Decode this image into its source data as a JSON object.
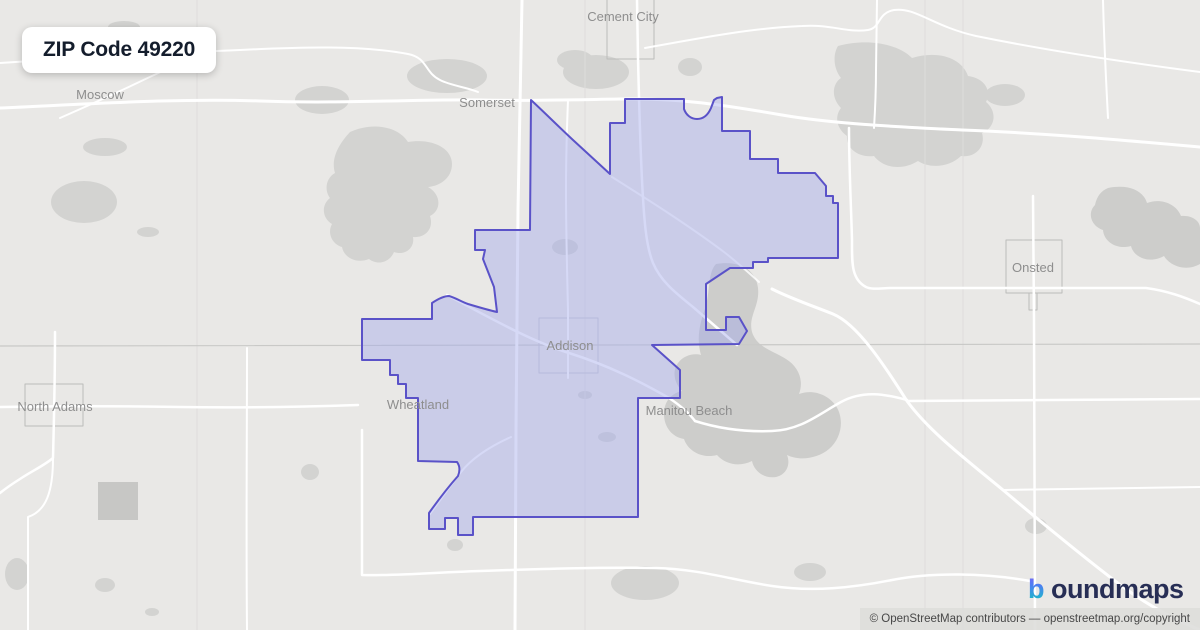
{
  "badge": {
    "title": "ZIP Code 49220"
  },
  "logo": {
    "icon_char": "b",
    "text": "oundmaps",
    "text_color": "#272e55",
    "gradient": [
      "#8b5cf6",
      "#4f7df3",
      "#1cb8c9"
    ]
  },
  "attribution": {
    "text": "© OpenStreetMap contributors — openstreetmap.org/copyright"
  },
  "map": {
    "bg": "#e9e8e6",
    "colors": {
      "patch": "#d3d3d1",
      "patch_dark": "#c7c7c5",
      "water": "#cdcdcb",
      "road": "#ffffff",
      "grid": "#dedddc",
      "county_line": "#c9c9c7",
      "village_square": "#bcbcba",
      "boundary_stroke": "#5a52c8",
      "boundary_fill": "rgba(164,170,234,0.45)"
    },
    "shapes": [
      {
        "name": "map-background",
        "type": "rect",
        "x": 0,
        "y": 0,
        "w": 1200,
        "h": 630,
        "fill": "#e9e8e6"
      },
      {
        "name": "woods-patch",
        "type": "ellipse",
        "cx": 124,
        "cy": 27,
        "rx": 16,
        "ry": 6,
        "fill": "#d3d3d1"
      },
      {
        "name": "woods-patch",
        "type": "ellipse",
        "cx": 322,
        "cy": 100,
        "rx": 27,
        "ry": 14,
        "fill": "#d3d3d1"
      },
      {
        "name": "woods-patch",
        "type": "ellipse",
        "cx": 105,
        "cy": 147,
        "rx": 22,
        "ry": 9,
        "fill": "#d3d3d1"
      },
      {
        "name": "woods-patch",
        "type": "ellipse",
        "cx": 84,
        "cy": 202,
        "rx": 33,
        "ry": 21,
        "fill": "#d3d3d1"
      },
      {
        "name": "woods-patch",
        "type": "ellipse",
        "cx": 148,
        "cy": 232,
        "rx": 11,
        "ry": 5,
        "fill": "#d3d3d1"
      },
      {
        "name": "woods-patch",
        "type": "ellipse",
        "cx": 447,
        "cy": 76,
        "rx": 40,
        "ry": 17,
        "fill": "#d3d3d1"
      },
      {
        "name": "woods-patch",
        "type": "ellipse",
        "cx": 596,
        "cy": 72,
        "rx": 33,
        "ry": 17,
        "fill": "#d3d3d1"
      },
      {
        "name": "woods-patch",
        "type": "ellipse",
        "cx": 575,
        "cy": 60,
        "rx": 18,
        "ry": 10,
        "fill": "#d3d3d1"
      },
      {
        "name": "woods-patch",
        "type": "ellipse",
        "cx": 690,
        "cy": 67,
        "rx": 12,
        "ry": 9,
        "fill": "#d3d3d1"
      },
      {
        "name": "forest-northwest",
        "type": "path",
        "fill": "#d3d3d1",
        "d": "M350,132 C372,122 398,126 408,142 C432,138 452,148 452,164 C452,178 440,186 428,187 C441,194 442,210 430,216 C434,228 426,238 413,237 C415,248 405,256 394,252 C390,262 378,266 369,259 C357,264 344,258 342,247 C332,244 327,233 332,224 C322,218 321,205 330,198 C324,190 326,178 335,173 C331,160 337,146 350,132 Z"
      },
      {
        "name": "forest-northeast",
        "type": "path",
        "fill": "#d3d3d1",
        "d": "M838,46 C868,38 898,44 912,58 C938,50 962,58 968,76 C984,78 992,90 986,102 C998,112 995,128 982,133 C986,147 975,158 961,156 C950,167 930,169 918,161 C902,171 883,168 874,156 C858,158 846,148 847,136 C837,129 834,117 841,108 C831,98 832,84 841,78 C833,68 833,54 838,46 Z"
      },
      {
        "name": "woods-patch",
        "type": "ellipse",
        "cx": 1005,
        "cy": 95,
        "rx": 20,
        "ry": 11,
        "fill": "#d3d3d1"
      },
      {
        "name": "lake-east",
        "type": "path",
        "fill": "#cdcdcb",
        "d": "M1108,188 C1128,184 1143,190 1147,203 C1160,198 1176,203 1181,216 C1192,215 1200,221 1200,228 L1200,264 C1186,272 1170,266 1164,256 C1150,264 1134,258 1131,246 C1117,250 1104,242 1103,230 C1091,226 1087,213 1095,205 C1097,196 1101,191 1108,188 Z"
      },
      {
        "name": "devils-lake",
        "type": "path",
        "fill": "#cdcdcb",
        "d": "M716,264 C740,260 756,270 758,288 C760,306 748,316 752,332 C757,348 774,351 786,359 C799,367 804,381 799,394 C812,389 828,394 836,406 C845,420 841,439 829,449 C817,459 799,461 787,455 C791,465 786,475 776,477 C764,479 754,471 752,461 C740,467 726,465 717,455 C702,459 688,451 684,439 C672,437 664,427 664,414 C664,401 672,393 682,391 C674,383 672,371 678,363 C684,355 694,353 701,355 C696,338 700,322 706,306 C710,290 708,272 716,264 Z"
      },
      {
        "name": "woods-patch",
        "type": "ellipse",
        "cx": 565,
        "cy": 247,
        "rx": 13,
        "ry": 8,
        "fill": "#d3d3d1"
      },
      {
        "name": "woods-patch",
        "type": "ellipse",
        "cx": 585,
        "cy": 395,
        "rx": 7,
        "ry": 4,
        "fill": "#d3d3d1"
      },
      {
        "name": "woods-patch",
        "type": "ellipse",
        "cx": 607,
        "cy": 437,
        "rx": 9,
        "ry": 5,
        "fill": "#d3d3d1"
      },
      {
        "name": "woods-patch",
        "type": "ellipse",
        "cx": 645,
        "cy": 583,
        "rx": 34,
        "ry": 17,
        "fill": "#d3d3d1"
      },
      {
        "name": "woods-patch",
        "type": "ellipse",
        "cx": 810,
        "cy": 572,
        "rx": 16,
        "ry": 9,
        "fill": "#d3d3d1"
      },
      {
        "name": "woods-patch",
        "type": "ellipse",
        "cx": 1036,
        "cy": 526,
        "rx": 11,
        "ry": 8,
        "fill": "#d3d3d1"
      },
      {
        "name": "woods-patch-dark",
        "type": "rect",
        "x": 98,
        "y": 482,
        "w": 40,
        "h": 38,
        "fill": "#c7c7c5"
      },
      {
        "name": "woods-patch",
        "type": "ellipse",
        "cx": 17,
        "cy": 574,
        "rx": 12,
        "ry": 16,
        "fill": "#d3d3d1"
      },
      {
        "name": "woods-patch",
        "type": "ellipse",
        "cx": 105,
        "cy": 585,
        "rx": 10,
        "ry": 7,
        "fill": "#d3d3d1"
      },
      {
        "name": "woods-patch",
        "type": "ellipse",
        "cx": 152,
        "cy": 612,
        "rx": 7,
        "ry": 4,
        "fill": "#d3d3d1"
      },
      {
        "name": "woods-patch",
        "type": "ellipse",
        "cx": 310,
        "cy": 472,
        "rx": 9,
        "ry": 8,
        "fill": "#d3d3d1"
      },
      {
        "name": "woods-patch",
        "type": "ellipse",
        "cx": 455,
        "cy": 545,
        "rx": 8,
        "ry": 6,
        "fill": "#d3d3d1"
      },
      {
        "name": "section-line",
        "type": "line",
        "x1": 197,
        "y1": 0,
        "x2": 197,
        "y2": 630,
        "stroke": "#dedddc",
        "width": 1
      },
      {
        "name": "section-line",
        "type": "line",
        "x1": 585,
        "y1": 0,
        "x2": 585,
        "y2": 630,
        "stroke": "#dedddc",
        "width": 1
      },
      {
        "name": "section-line",
        "type": "line",
        "x1": 925,
        "y1": 0,
        "x2": 925,
        "y2": 630,
        "stroke": "#dedddc",
        "width": 1
      },
      {
        "name": "section-line",
        "type": "line",
        "x1": 963,
        "y1": 0,
        "x2": 963,
        "y2": 630,
        "stroke": "#dedddc",
        "width": 1
      },
      {
        "name": "county-line",
        "type": "line",
        "x1": 0,
        "y1": 346,
        "x2": 1200,
        "y2": 344,
        "stroke": "#c9c9c7",
        "width": 1.2
      },
      {
        "name": "village-square-cement-city",
        "type": "rect",
        "x": 607,
        "y": -8,
        "w": 47,
        "h": 67,
        "fill": "none",
        "stroke": "#bcbcba",
        "width": 1
      },
      {
        "name": "village-square-addison",
        "type": "rect",
        "x": 539,
        "y": 318,
        "w": 59,
        "h": 55,
        "fill": "none",
        "stroke": "#c6c6ce",
        "width": 1
      },
      {
        "name": "village-square-onsted",
        "type": "rect",
        "x": 1006,
        "y": 240,
        "w": 56,
        "h": 53,
        "fill": "none",
        "stroke": "#bcbcba",
        "width": 1
      },
      {
        "name": "village-square-onsted-tab",
        "type": "path",
        "fill": "none",
        "stroke": "#bcbcba",
        "width": 1,
        "d": "M1029,293 L1029,310 L1037,310 L1037,293"
      },
      {
        "name": "village-square-north-adams",
        "type": "rect",
        "x": 25,
        "y": 384,
        "w": 58,
        "h": 42,
        "fill": "none",
        "stroke": "#bcbcba",
        "width": 1
      },
      {
        "name": "road-somerset-highway",
        "type": "path",
        "fill": "none",
        "stroke": "#ffffff",
        "width": 3,
        "d": "M0,108 C90,104 180,98 260,101 C340,104 420,99 480,100 C520,101 560,100 620,99 C680,98 724,105 782,115 C834,124 902,127 962,130 C1042,133 1122,140 1200,147"
      },
      {
        "name": "road-top-left",
        "type": "path",
        "fill": "none",
        "stroke": "#ffffff",
        "width": 2,
        "d": "M0,63 C80,58 160,53 240,50 C300,47 362,45 408,54 C428,58 424,72 440,80 C452,86 466,87 478,92"
      },
      {
        "name": "road-north-loop",
        "type": "path",
        "fill": "none",
        "stroke": "#ffffff",
        "width": 2,
        "d": "M645,48 C700,38 752,28 802,26 C832,24 846,33 868,30 C881,28 877,13 894,10 C916,7 932,26 976,36 C1030,47 1100,59 1200,72"
      },
      {
        "name": "road-moscow-diagonal",
        "type": "path",
        "fill": "none",
        "stroke": "#ffffff",
        "width": 2,
        "d": "M60,118 C85,107 110,96 135,84 C160,72 186,60 212,50"
      },
      {
        "name": "road-west-vertical",
        "type": "path",
        "fill": "none",
        "stroke": "#ffffff",
        "width": 3,
        "d": "M522,0 C521,70 519,140 518,210 C517,290 516,360 516,430 C516,500 515,565 515,630"
      },
      {
        "name": "road-cement-city",
        "type": "path",
        "fill": "none",
        "stroke": "#ffffff",
        "width": 2.5,
        "d": "M637,0 L638,58 C639,100 640,140 642,180 C644,220 646,246 653,263 C661,282 677,294 693,307 C707,319 723,333 737,345"
      },
      {
        "name": "road-top-vertical",
        "type": "path",
        "fill": "none",
        "stroke": "#ffffff",
        "width": 2,
        "d": "M877,0 L876,70 C876,95 875,112 874,128"
      },
      {
        "name": "road-top-right-vertical",
        "type": "path",
        "fill": "none",
        "stroke": "#ffffff",
        "width": 2,
        "d": "M1103,0 C1104,40 1106,80 1108,118"
      },
      {
        "name": "road-addison-north",
        "type": "path",
        "fill": "none",
        "stroke": "#ffffff",
        "width": 2,
        "d": "M568,378 L568,310 C567,270 566,230 566,190 C566,150 567,125 568,100"
      },
      {
        "name": "road-inner-diagonal",
        "type": "path",
        "fill": "none",
        "stroke": "#ffffff",
        "width": 2,
        "opacity": 0.8,
        "d": "M612,177 C650,201 688,225 724,252 C737,262 748,272 759,282"
      },
      {
        "name": "road-addison-northwest",
        "type": "path",
        "fill": "none",
        "stroke": "#ffffff",
        "width": 2.5,
        "d": "M447,295 C490,318 531,341 569,353 C610,366 641,382 669,398 C681,406 689,413 695,421"
      },
      {
        "name": "road-notch",
        "type": "path",
        "fill": "none",
        "stroke": "#ffffff",
        "width": 2,
        "d": "M430,514 C441,499 451,485 461,472 C473,457 491,446 511,437"
      },
      {
        "name": "road-manitou",
        "type": "path",
        "fill": "none",
        "stroke": "#ffffff",
        "width": 2.5,
        "d": "M695,421 C720,429 746,432 772,431 C801,430 819,414 841,402 C863,390 885,394 907,400"
      },
      {
        "name": "road-se-diagonal",
        "type": "path",
        "fill": "none",
        "stroke": "#ffffff",
        "width": 3,
        "d": "M772,289 C792,299 813,306 833,314 C857,324 883,363 907,401 C929,431 963,457 1003,490 C1041,522 1081,555 1119,584 C1147,605 1173,619 1200,630"
      },
      {
        "name": "road-east-corner",
        "type": "path",
        "fill": "none",
        "stroke": "#ffffff",
        "width": 2.5,
        "d": "M849,128 C849,166 851,204 852,240 C852,262 851,279 866,287 C872,290 882,288 892,288 L1146,288 C1168,291 1184,297 1200,304"
      },
      {
        "name": "road-onsted-vertical",
        "type": "path",
        "fill": "none",
        "stroke": "#ffffff",
        "width": 2.5,
        "d": "M1033,196 L1034,320 C1034,420 1035,520 1035,630"
      },
      {
        "name": "road-east-h400",
        "type": "path",
        "fill": "none",
        "stroke": "#ffffff",
        "width": 2.5,
        "d": "M907,401 C1004,401 1102,399 1200,399"
      },
      {
        "name": "road-east-h488",
        "type": "path",
        "fill": "none",
        "stroke": "#ffffff",
        "width": 2,
        "d": "M1003,490 C1069,489 1134,488 1200,487"
      },
      {
        "name": "road-north-adams",
        "type": "path",
        "fill": "none",
        "stroke": "#ffffff",
        "width": 2.5,
        "d": "M0,407 C60,406 120,406 180,407 C240,408 300,407 358,405"
      },
      {
        "name": "road-left-vertical",
        "type": "path",
        "fill": "none",
        "stroke": "#ffffff",
        "width": 2.5,
        "d": "M55,332 C55,380 54,420 53,458 C45,465 32,471 20,479 C12,484 5,489 0,493"
      },
      {
        "name": "road-left-lower",
        "type": "path",
        "fill": "none",
        "stroke": "#ffffff",
        "width": 2,
        "d": "M53,458 C53,492 46,511 28,517 C28,555 28,592 28,630"
      },
      {
        "name": "road-v247",
        "type": "path",
        "fill": "none",
        "stroke": "#ffffff",
        "width": 2,
        "d": "M247,348 C247,440 246,530 247,630"
      },
      {
        "name": "road-bottom",
        "type": "path",
        "fill": "none",
        "stroke": "#ffffff",
        "width": 2.5,
        "d": "M362,430 L362,575 C400,576 440,572 480,571 C540,569 600,567 655,568 C700,569 732,580 772,586 C812,592 852,588 892,580 C932,572 986,573 1030,581"
      },
      {
        "name": "zip-boundary-polygon",
        "type": "path",
        "fill": "rgba(164,170,234,0.45)",
        "stroke": "#5a52c8",
        "width": 2,
        "d": "M531,100 C545,113 559,127 573,140 C586,152 598,163 610,174 L610,123 L625,123 L625,99 L684,99 L684,109 C686,115 691,119 697,119 C703,119 708,115 711,108 L714,100 L717,98 L722,97 L722,131 L750,131 L750,159 L778,159 L778,173 L815,173 L826,186 L826,196 L833,196 L833,203 L838,203 L838,258 L768,258 L768,262 L753,262 L753,268 L730,268 L706,284 L706,330 L726,330 L726,317 L739,317 L747,331 L739,344 L652,345 L680,370 L680,398 L638,398 L638,517 L473,517 L473,535 L458,535 L458,518 L445,518 L445,529 L429,529 L429,513 C439,499 450,485 458,476 C460,471 460,466 457,462 L418,461 L418,398 L406,398 L406,384 L398,384 L398,375 L390,375 L390,360 L362,360 L362,319 L432,319 L432,303 C438,299 444,296 449,296 C456,298 462,302 468,304 C478,307 488,310 497,312 L494,287 L483,259 L485,250 L475,250 L475,230 L530,230 Z"
      }
    ],
    "labels": [
      {
        "name": "moscow",
        "text": "Moscow",
        "x": 100,
        "y": 99
      },
      {
        "name": "somerset",
        "text": "Somerset",
        "x": 487,
        "y": 107
      },
      {
        "name": "cement-city",
        "text": "Cement City",
        "x": 623,
        "y": 21
      },
      {
        "name": "onsted",
        "text": "Onsted",
        "x": 1033,
        "y": 272
      },
      {
        "name": "north-adams",
        "text": "North Adams",
        "x": 55,
        "y": 411
      },
      {
        "name": "wheatland",
        "text": "Wheatland",
        "x": 418,
        "y": 409
      },
      {
        "name": "addison",
        "text": "Addison",
        "x": 570,
        "y": 350,
        "fill": "#8f8f9b"
      },
      {
        "name": "manitou-beach",
        "text": "Manitou Beach",
        "x": 689,
        "y": 415
      }
    ]
  }
}
